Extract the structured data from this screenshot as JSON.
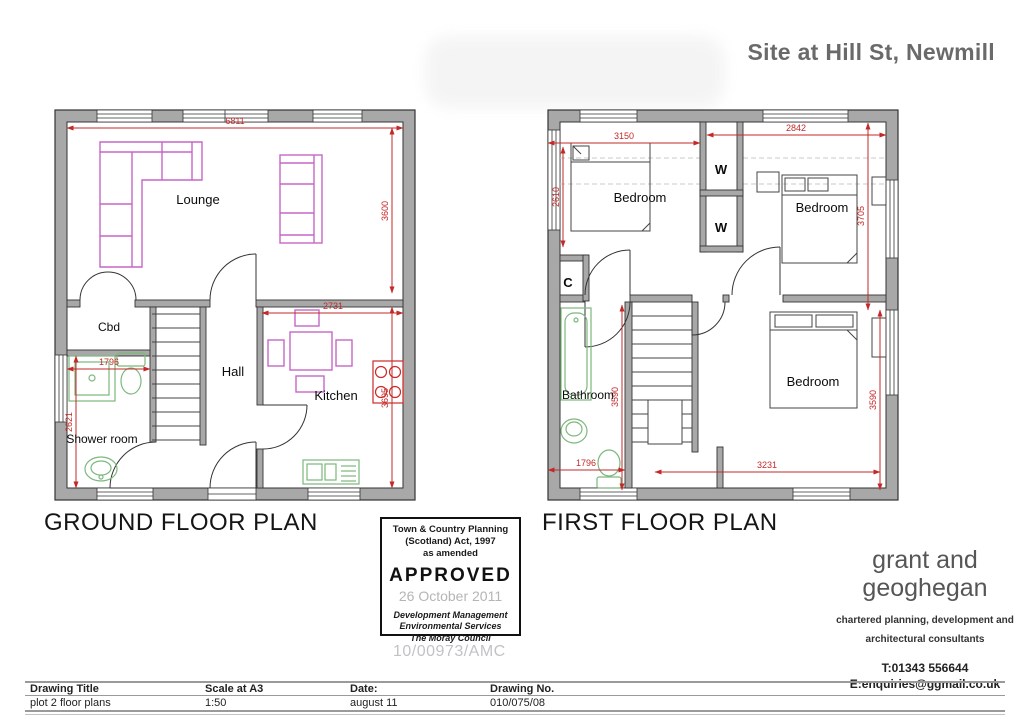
{
  "header": {
    "site_title": "Site at Hill St, Newmill"
  },
  "ground_floor": {
    "caption": "GROUND FLOOR PLAN",
    "rooms": {
      "lounge": "Lounge",
      "cbd": "Cbd",
      "hall": "Hall",
      "kitchen": "Kitchen",
      "shower_room": "Shower room"
    },
    "dimensions": {
      "overall_width": "6811",
      "lounge_depth": "3600",
      "kitchen_width": "2731",
      "kitchen_depth": "3695",
      "shower_width": "1796",
      "shower_depth": "2621"
    }
  },
  "first_floor": {
    "caption": "FIRST FLOOR PLAN",
    "rooms": {
      "bedroom_1": "Bedroom",
      "bedroom_2": "Bedroom",
      "bedroom_3": "Bedroom",
      "wardrobe_1": "W",
      "wardrobe_2": "W",
      "cupboard": "C",
      "bathroom": "Bathroom"
    },
    "dimensions": {
      "bedroom1_width": "3150",
      "bedroom2_width": "2842",
      "bedroom1_depth": "2610",
      "bedroom2_depth": "3705",
      "stairwell_depth": "3590",
      "bedroom3_depth": "3590",
      "bathroom_width": "1796",
      "bedroom3_width": "3231"
    }
  },
  "approval_stamp": {
    "act_line1": "Town & Country Planning",
    "act_line2": "(Scotland) Act, 1997",
    "act_line3": "as amended",
    "status": "APPROVED",
    "date": "26 October 2011",
    "dept_line1": "Development Management",
    "dept_line2": "Environmental Services",
    "dept_line3": "The Moray Council"
  },
  "watermark": "10/00973/AMC",
  "firm": {
    "name_line1": "grant and",
    "name_line2": "geoghegan",
    "tagline_line1": "chartered planning, development and",
    "tagline_line2": "architectural consultants",
    "phone": "T:01343 556644",
    "email": "E:enquiries@ggmail.co.uk"
  },
  "title_block": {
    "headers": {
      "drawing_title": "Drawing Title",
      "scale": "Scale at A3",
      "date": "Date:",
      "drawing_no": "Drawing No."
    },
    "values": {
      "drawing_title": "plot 2 floor plans",
      "scale": "1:50",
      "date": "august 11",
      "drawing_no": "010/075/08"
    }
  },
  "colors": {
    "dimension_red": "#c22a29",
    "furniture_magenta": "#c667c6",
    "sanitary_green": "#7cb87c",
    "wall_gray": "#a8a8a8"
  }
}
